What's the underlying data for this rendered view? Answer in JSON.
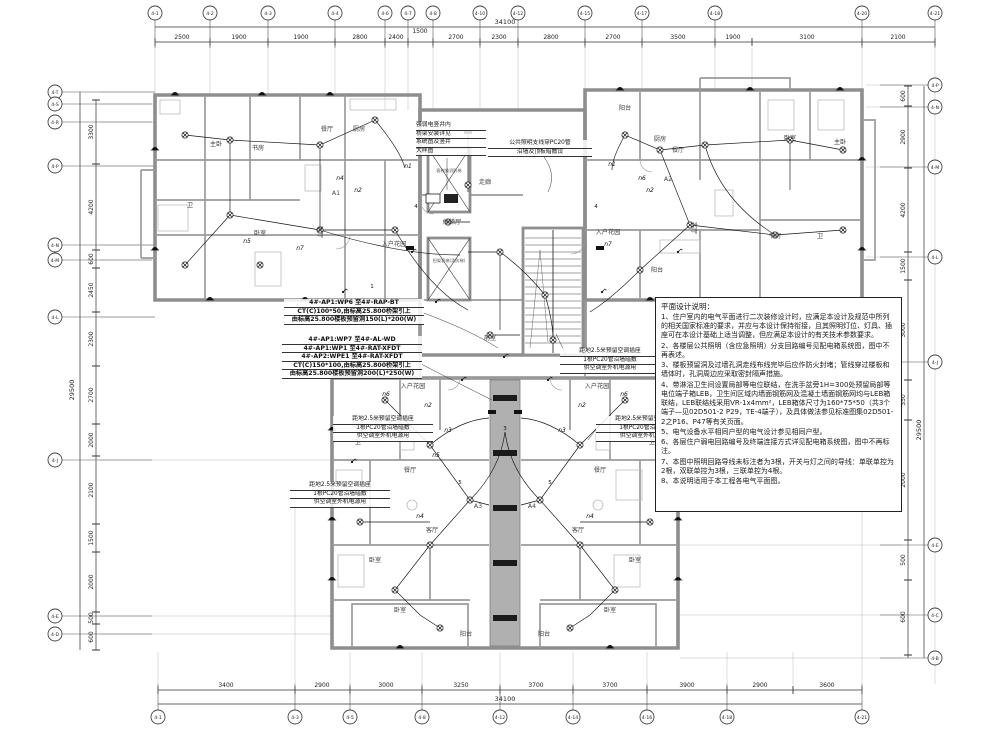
{
  "sheet": {
    "bg": "#ffffff",
    "line_color": "#1b1b1b",
    "wall_color": "#8e8e8e",
    "accent": "#b0b0b0"
  },
  "grid": {
    "top": {
      "total": "34100",
      "bubbles": [
        "4-1",
        "4-2",
        "4-3",
        "4-4",
        "4-6",
        "4-7",
        "4-8",
        "4-10",
        "4-12",
        "4-15",
        "4-17",
        "4-18",
        "4-20",
        "4-21"
      ],
      "dims": [
        "2500",
        "1900",
        "1900",
        "2800",
        "2400",
        "1500",
        "2700",
        "2300",
        "2800",
        "2700",
        "3500",
        "1900",
        "3100",
        "2100"
      ]
    },
    "bottom": {
      "total": "34100",
      "bubbles": [
        "4-1",
        "4-3",
        "4-5",
        "4-8",
        "4-12",
        "4-14",
        "4-16",
        "4-18",
        "4-21"
      ],
      "dims": [
        "3400",
        "2900",
        "3000",
        "3250",
        "3700",
        "3700",
        "3900",
        "2900",
        "3600"
      ]
    },
    "left": {
      "total": "29500",
      "bubbles": [
        "4-T",
        "4-S",
        "4-R",
        "4-P",
        "4-N",
        "4-M",
        "4-L",
        "4-J",
        "4-E",
        "4-D"
      ],
      "dims": [
        "3300",
        "4200",
        "600",
        "2450",
        "2300",
        "2700",
        "2000",
        "2100",
        "1500",
        "2000",
        "500",
        "600"
      ]
    },
    "right": {
      "total": "29500",
      "bubbles": [
        "4-P",
        "4-N",
        "4-M",
        "4-L",
        "4-J",
        "4-E",
        "4-C",
        "4-B"
      ],
      "dims": [
        "600",
        "2900",
        "4200",
        "1500",
        "3000",
        "350",
        "2000",
        "500",
        "600"
      ]
    }
  },
  "rooms": {
    "a1": "A1",
    "a2": "A2",
    "a3": "A3",
    "a4": "A4",
    "master": "主卧",
    "bed": "卧室",
    "study": "书房",
    "dining": "餐厅",
    "kitchen": "厨房",
    "living": "客厅",
    "garden": "入户花园",
    "balcony": "阳台",
    "bath": "卫",
    "corridor": "走廊",
    "lobby": "候梯厅",
    "anteroom": "前室",
    "lift1": "客梯兼消防梯",
    "lift2": "担架客梯(消防梯)"
  },
  "wires": {
    "n1": "n1",
    "n2": "n2",
    "n3": "n3",
    "n4": "n4",
    "n5": "n5",
    "n6": "n6",
    "n7": "n7",
    "c1": "1",
    "c3": "3",
    "c4": "4",
    "c5": "5"
  },
  "callouts": {
    "tray1": {
      "l1": "4#-AP1:WP6 至4#-RAP-BT",
      "l2": "CT(C)100*50,由标高25.800桥架引上",
      "l3": "由标高25.800楼板预留洞150(L)*200(W)"
    },
    "tray2": {
      "l1": "4#-AP1:WP7 至4#-AL-WD",
      "l2": "4#-AP1:WP1 至4#-RAT-XFDT",
      "l3": "4#-AP2:WPE1 至4#-RAT-XFDT",
      "l4": "CT(C)150*100,由标高25.800桥架引上",
      "l5": "由标高25.800楼板预留洞200(L)*250(W)"
    },
    "ac": {
      "l1": "距地2.5米预留空调插座",
      "l2": "1根PC20管沿墙暗敷",
      "l3": "供空调室外机电源用"
    },
    "riser": {
      "l1": "强弱电竖井内",
      "l2": "桥架安装详见",
      "l3": "系统图及竖井",
      "l4": "大样图"
    },
    "lighting": {
      "l1": "公共照明支线穿PC20管",
      "l2": "沿墙及顶板暗敷设"
    }
  },
  "notes": {
    "title": "平面设计说明：",
    "items": [
      "1、住户室内的电气平面进行二次装修设计时，应满足本设计及规范中所列的相关国家标准的要求，并应与本设计保持衔接，且其照明灯位、灯具、插座可在本设计基础上适当调整，但应满足本设计的有关技术参数要求。",
      "2、各楼层公共照明（含应急照明）分支回路编号见配电箱系统图，图中不再表述。",
      "3、楼板预留洞及过墙孔洞走线布线完毕后应作防火封堵；管线穿过楼板和墙体时，孔洞周边应采取密封隔声措施。",
      "4、带淋浴卫生间设置局部等电位联结，在洗手盆旁1H=300处预留局部等电位端子箱LEB，卫生间区域内墙面钢筋网及混凝土墙面钢筋网均与LEB箱联结，LEB联结线采用VR-1x4mm²，LEB箱体尺寸为160*75*50（共3个端子—见02D501-2 P29，TE-4端子），及具体做法参见标准图集02D501-2之P16、P47等有关页面。",
      "5、电气设备水平相同户型的电气设计参见相同户型。",
      "6、各层住户弱电回路编号及终端连接方式详见配电箱系统图，图中不再标注。",
      "7、本图中照明回路导线未标注者为3根，开关与灯之间的导线：单联单控为2根，双联单控为3根，三联单控为4根。",
      "8、本说明适用于本工程各电气平面图。"
    ]
  }
}
